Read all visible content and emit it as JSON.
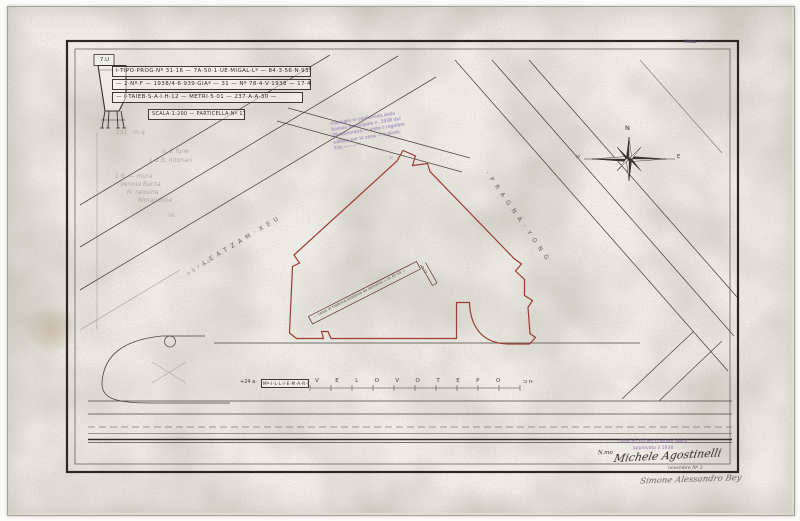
{
  "corner_label": "7.U",
  "title_block": {
    "rows": [
      "I·TIPO·PROG·Nº 31·16 — 7A·50·1·UE·MIGAL·Lº — 84·3·56·N·939 —",
      "— 2·Nº·F — 1938/4·6·939·GIAª — 31 — Nº 78·4·V·1938 — 17·48·892 —",
      "— I·TAIEB·S·A·I·H·12 — METRI·5·01 — 237·A·A·30 —"
    ],
    "scale_note": "SCALA·1:200 — PARTICELLA·Nº 178"
  },
  "pencil_notes": [
    "151 · m.q.",
    "n. 2 fune",
    "L 2 B. intonari",
    "1 B. — mura",
    "Verona Banta",
    "N. ramona",
    "Rimandone",
    "te."
  ],
  "pencil_marks": "× ·",
  "stamp_top": {
    "color": "#7d55a8",
    "lines": [
      "rilasciato in conformità della",
      "licenza municipale n. 1938 del",
      "29 novembre — visto il regolam.",
      "edilizio per la zona — il dirett.",
      "F.to ————"
    ]
  },
  "streets": {
    "left_name": "·LEATZAM·XEU",
    "left_name_small": "obrno",
    "right_name": "·PRAGNA·YONG",
    "bottom": {
      "prefix": "+24 a·",
      "box_label": "Mª·I·L·L·I·E·M·A·R·I",
      "letters": "VELOVOTEPO",
      "suffix": "⊐ n·"
    }
  },
  "plot": {
    "outline_color": "#9e3b33",
    "band_text": "— corpo di fabbrica esistente da demolire — m 42·50 —",
    "band_label": "m 12"
  },
  "compass": {
    "north": "N",
    "east": "E",
    "west": "W"
  },
  "stamp_bottom": {
    "color": "#8d5fb0",
    "lines": [
      "UFFICIO TECNICO MUNICIPALE",
      "approvato il 1938"
    ]
  },
  "signatures": {
    "prefix": "N.mo",
    "primary": "Michele Agostinelli",
    "note": "novembre Nº 3",
    "secondary": "Simone Alessandro Bey"
  },
  "colors": {
    "paper": "#f0efe9",
    "ink": "#3c3833",
    "red": "#9e3b33",
    "purple": "#7d55a8"
  }
}
